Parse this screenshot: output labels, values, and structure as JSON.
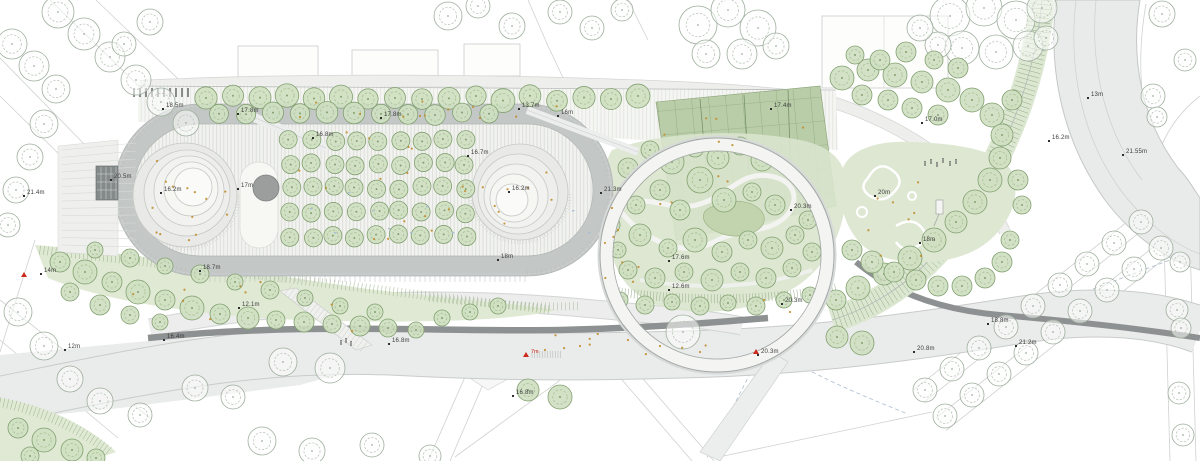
{
  "plan": {
    "elevation_labels": [
      {
        "text": "18.5m",
        "x": 166,
        "y": 108
      },
      {
        "text": "17.8m",
        "x": 241,
        "y": 113
      },
      {
        "text": "17.8m",
        "x": 384,
        "y": 117
      },
      {
        "text": "16.8m",
        "x": 316,
        "y": 137
      },
      {
        "text": "13.7m",
        "x": 522,
        "y": 108
      },
      {
        "text": "16m",
        "x": 561,
        "y": 115
      },
      {
        "text": "20.5m",
        "x": 114,
        "y": 179
      },
      {
        "text": "16.2m",
        "x": 164,
        "y": 192
      },
      {
        "text": "17m",
        "x": 241,
        "y": 188
      },
      {
        "text": "16.7m",
        "x": 471,
        "y": 155
      },
      {
        "text": "16.2m",
        "x": 512,
        "y": 191
      },
      {
        "text": "21.3m",
        "x": 604,
        "y": 192
      },
      {
        "text": "18m",
        "x": 501,
        "y": 259
      },
      {
        "text": "17.6m",
        "x": 672,
        "y": 260
      },
      {
        "text": "12.6m",
        "x": 672,
        "y": 289
      },
      {
        "text": "20.3m",
        "x": 794,
        "y": 209
      },
      {
        "text": "20.3m",
        "x": 785,
        "y": 303
      },
      {
        "text": "20.3m",
        "x": 761,
        "y": 354
      },
      {
        "text": "17.4m",
        "x": 774,
        "y": 108
      },
      {
        "text": "17.0m",
        "x": 925,
        "y": 122
      },
      {
        "text": "20m",
        "x": 878,
        "y": 195
      },
      {
        "text": "18m",
        "x": 923,
        "y": 242
      },
      {
        "text": "16.2m",
        "x": 1052,
        "y": 140
      },
      {
        "text": "13m",
        "x": 1091,
        "y": 97
      },
      {
        "text": "21.55m",
        "x": 1126,
        "y": 154
      },
      {
        "text": "20.8m",
        "x": 917,
        "y": 351
      },
      {
        "text": "18.8m",
        "x": 991,
        "y": 323
      },
      {
        "text": "21.2m",
        "x": 1019,
        "y": 345
      },
      {
        "text": "21.4m",
        "x": 27,
        "y": 195
      },
      {
        "text": "18.7m",
        "x": 203,
        "y": 270
      },
      {
        "text": "12.1m",
        "x": 242,
        "y": 307
      },
      {
        "text": "16.4m",
        "x": 167,
        "y": 339
      },
      {
        "text": "12m",
        "x": 68,
        "y": 349
      },
      {
        "text": "16.8m",
        "x": 392,
        "y": 343
      },
      {
        "text": "16.8m",
        "x": 516,
        "y": 395
      },
      {
        "text": "14m",
        "x": 44,
        "y": 273
      }
    ],
    "red_markers": [
      {
        "x": 21,
        "y": 272,
        "label": ""
      },
      {
        "x": 523,
        "y": 352,
        "label": "7m"
      },
      {
        "x": 753,
        "y": 349,
        "label": ""
      }
    ],
    "colors": {
      "background": "#ffffff",
      "road": "#eaebeb",
      "road_edge": "#c9cccb",
      "dark_asphalt": "#8e9192",
      "track_band": "#c3c7c6",
      "paving_stripe": "#dadcd7",
      "park_tree_fill": "#cfdfc1",
      "park_tree_stroke": "#82a070",
      "street_tree_stroke": "#9fae9e",
      "wild_green": "#dfe9d3",
      "allotment_green": "#b9cda8",
      "mound_fill": "#efefed",
      "accent_orange": "#c18c2b",
      "accent_red": "#cc2b1c",
      "accent_blue": "#9db0c4",
      "label_text": "#3b3b3b"
    }
  }
}
